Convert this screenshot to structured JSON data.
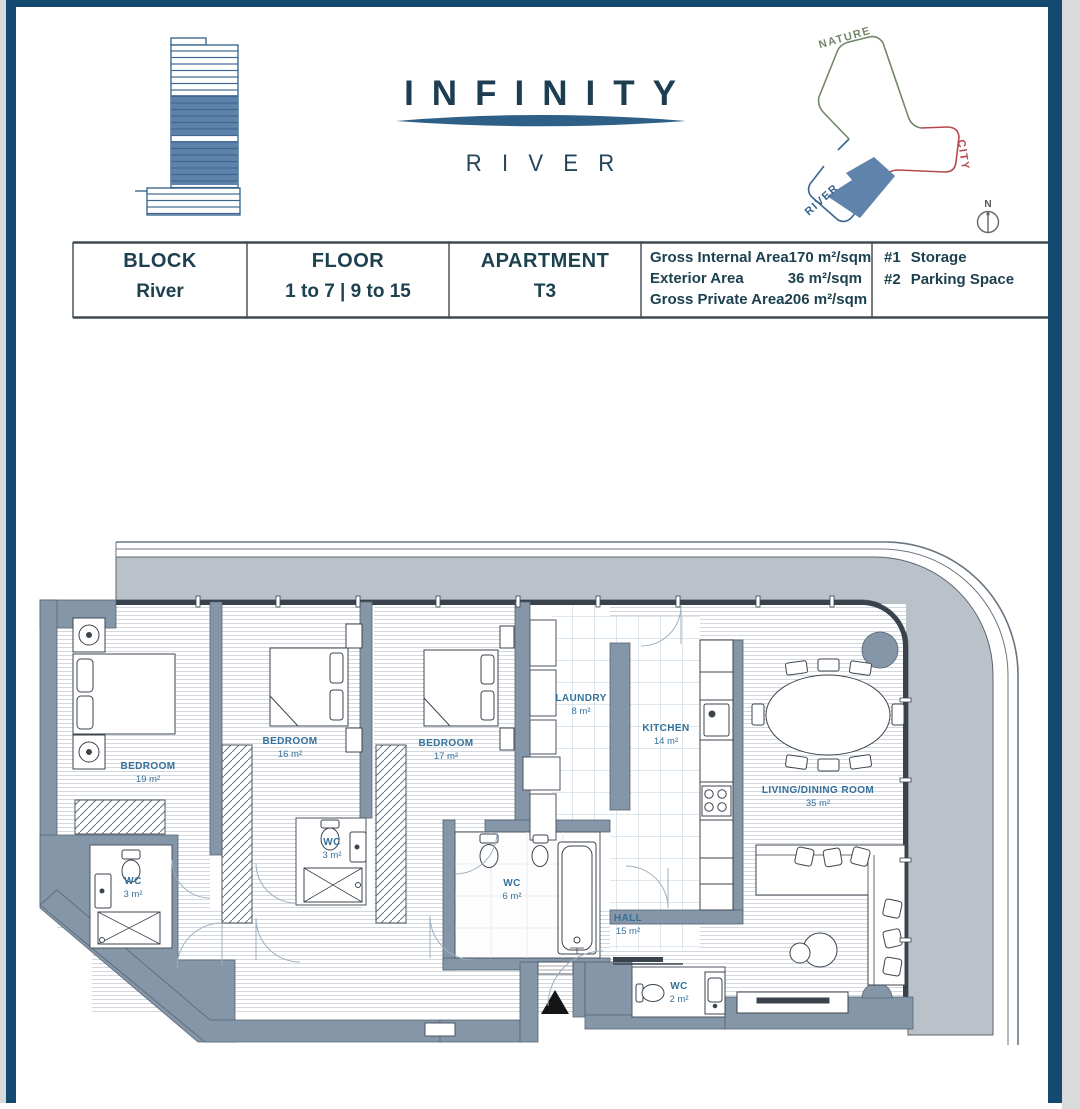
{
  "brand": {
    "title": "INFINITY",
    "subtitle": "RIVER"
  },
  "site": {
    "nature": "NATURE",
    "city": "CITY",
    "river": "RIVER",
    "compass": "N"
  },
  "info_table": {
    "columns": [
      {
        "label": "BLOCK",
        "value": "River"
      },
      {
        "label": "FLOOR",
        "value": "1 to 7 | 9 to 15"
      },
      {
        "label": "APARTMENT",
        "value": "T3"
      }
    ],
    "areas": [
      {
        "label": "Gross Internal Area",
        "value": "170 m²/sqm"
      },
      {
        "label": "Exterior Area",
        "value": "36 m²/sqm"
      },
      {
        "label": "Gross Private Area",
        "value": "206 m²/sqm"
      }
    ],
    "extras": [
      {
        "num": "#1",
        "label": "Storage"
      },
      {
        "num": "#2",
        "label": "Parking Space"
      }
    ]
  },
  "floor_plan": {
    "rooms": [
      {
        "name": "BEDROOM",
        "area": "19 m²"
      },
      {
        "name": "BEDROOM",
        "area": "16 m²"
      },
      {
        "name": "BEDROOM",
        "area": "17 m²"
      },
      {
        "name": "LAUNDRY",
        "area": "8 m²"
      },
      {
        "name": "KITCHEN",
        "area": "14 m²"
      },
      {
        "name": "LIVING/DINING ROOM",
        "area": "35 m²"
      },
      {
        "name": "WC",
        "area": "3 m²"
      },
      {
        "name": "WC",
        "area": "3 m²"
      },
      {
        "name": "WC",
        "area": "6 m²"
      },
      {
        "name": "HALL",
        "area": "15 m²"
      },
      {
        "name": "WC",
        "area": "2 m²"
      }
    ],
    "colors": {
      "wall": "#8496a8",
      "terrace": "#bac1c9",
      "room_label": "#35719b",
      "frame": "#14496f",
      "brand_accent": "#2e5f86",
      "nature_green": "#72876a",
      "city_red": "#b5494d",
      "river_blue": "#39648c",
      "highlight_blue": "#5f83ab"
    }
  }
}
